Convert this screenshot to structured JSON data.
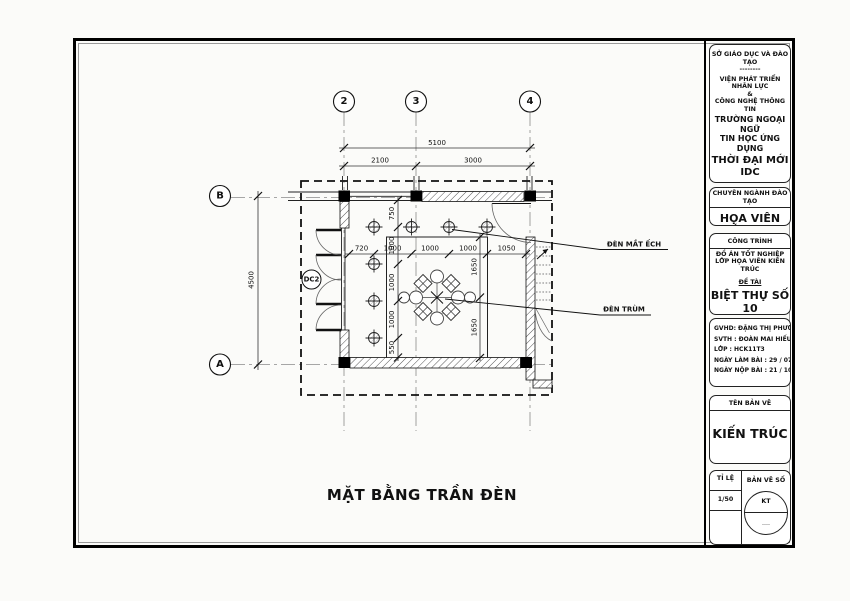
{
  "plan": {
    "title": "MẶT BẰNG TRẦN ĐÈN",
    "grid_cols": [
      "2",
      "3",
      "4"
    ],
    "grid_rows": [
      "B",
      "A"
    ],
    "dims": {
      "total_width": "5100",
      "top_segments": [
        "2100",
        "3000"
      ],
      "total_height": "4500",
      "light_spacing_h": [
        "720",
        "1000",
        "1000",
        "1000",
        "1050"
      ],
      "light_spacing_v": [
        "750",
        "1000",
        "1000",
        "1000",
        "550"
      ],
      "ceiling_v": [
        "1650",
        "1650"
      ]
    },
    "labels": {
      "downlight": "ĐÈN MẮT ẾCH",
      "chandelier": "ĐÈN TRÙM",
      "door_tag": "DC2"
    }
  },
  "title_block": {
    "org": {
      "line1": "SỞ GIÁO DỤC VÀ ĐÀO TẠO",
      "line2": "--------",
      "line3": "VIỆN PHÁT TRIỂN NHÂN LỰC",
      "line4": "&",
      "line5": "CÔNG NGHỆ THÔNG TIN",
      "line6": "TRƯỜNG NGOẠI NGỮ",
      "line7": "TIN HỌC ỨNG DỤNG",
      "line8": "THỜI ĐẠI MỚI IDC",
      "addr1": "Địa chỉ : 40 Đinh Tiên Hoàng",
      "addr2": "P.Đa Kao    Q.1",
      "website": "Website : http://www.idcvn.com.vn"
    },
    "nganh": {
      "header": "CHUYÊN NGÀNH ĐÀO TẠO",
      "value": "HỌA VIÊN KIẾN TRÚC"
    },
    "cong_trinh": {
      "header": "CÔNG TRÌNH",
      "line1": "ĐỒ ÁN TỐT NGHIỆP",
      "line2": "LỚP HỌA VIÊN KIẾN TRÚC",
      "de_tai_label": "ĐỀ TÀI",
      "de_tai_value": "BIỆT THỰ SỐ 10"
    },
    "info": {
      "gvhd": "GVHD: ĐẶNG THỊ PHƯƠNG CHI",
      "svth": "SVTH : ĐOÀN MAI HIẾU",
      "lop": "LỚP    : HCK11T3",
      "ngay_lam": "NGÀY LÀM BÀI      : 29 / 07 / 2013",
      "ngay_nop": "NGÀY NỘP BÀI      : 21 / 10 / 2013"
    },
    "ten_ban_ve": {
      "header": "TÊN BẢN VẼ",
      "value": "KIẾN TRÚC"
    },
    "bottom": {
      "ti_le_label": "TỈ LỆ",
      "ti_le_value": "1/50",
      "ban_ve_so_label": "BẢN VẼ SỐ",
      "circle_top": "KT",
      "circle_bottom": "...."
    }
  }
}
